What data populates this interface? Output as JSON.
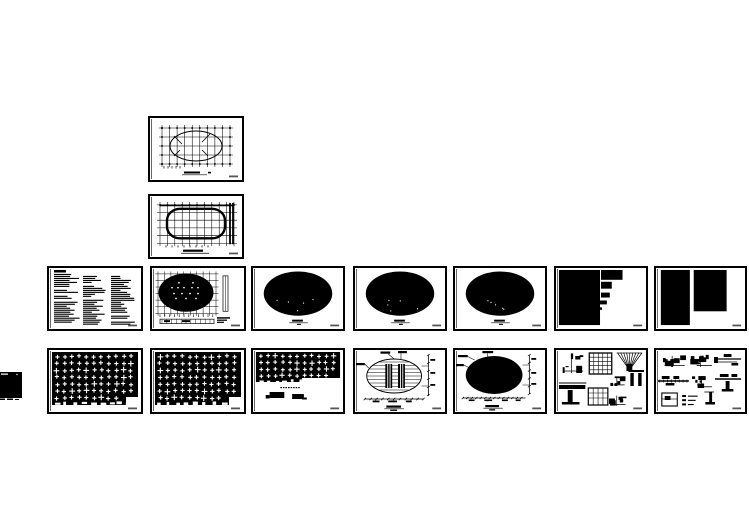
{
  "canvas": {
    "background": "#ffffff",
    "paper": "#ffffff",
    "ink": "#000000",
    "corner_mark": "#555555"
  },
  "sheets": [
    {
      "id": "S01",
      "name": "roof-framing-grid-plan",
      "type": "grid-ellipse",
      "row": 0,
      "col": 1,
      "seed": 11
    },
    {
      "id": "S02",
      "name": "foundation-grid-plan",
      "type": "grid-ring",
      "row": 1,
      "col": 1,
      "seed": 12
    },
    {
      "id": "S03",
      "name": "general-notes",
      "type": "notes",
      "row": 2,
      "col": 0,
      "seed": 21
    },
    {
      "id": "S04",
      "name": "pile-layout-plan",
      "type": "grid-filled-ellipse",
      "row": 2,
      "col": 1,
      "seed": 22
    },
    {
      "id": "S05",
      "name": "floor-plan-1",
      "type": "filled-ellipse",
      "row": 2,
      "col": 2,
      "seed": 23
    },
    {
      "id": "S06",
      "name": "floor-plan-2",
      "type": "filled-ellipse",
      "row": 2,
      "col": 3,
      "seed": 24
    },
    {
      "id": "S07",
      "name": "floor-plan-3",
      "type": "filled-ellipse",
      "row": 2,
      "col": 4,
      "seed": 25
    },
    {
      "id": "S08",
      "name": "schedule-table-1",
      "type": "blocks-a",
      "row": 2,
      "col": 5,
      "seed": 26
    },
    {
      "id": "S09",
      "name": "schedule-table-2",
      "type": "blocks-b",
      "row": 2,
      "col": 6,
      "seed": 27
    },
    {
      "id": "S10",
      "name": "framing-plan-dense-1",
      "type": "pile-grid",
      "row": 3,
      "col": 0,
      "seed": 31
    },
    {
      "id": "S11",
      "name": "framing-plan-dense-2",
      "type": "pile-grid",
      "row": 3,
      "col": 1,
      "seed": 32
    },
    {
      "id": "S12",
      "name": "framing-plan-partial",
      "type": "pile-partial",
      "row": 3,
      "col": 2,
      "seed": 33
    },
    {
      "id": "S13",
      "name": "roof-plan-with-cores",
      "type": "ellipse-hatch-cores",
      "row": 3,
      "col": 3,
      "seed": 34
    },
    {
      "id": "S14",
      "name": "roof-plan-filled",
      "type": "filled-ellipse-dims",
      "row": 3,
      "col": 4,
      "seed": 35
    },
    {
      "id": "S15",
      "name": "connection-details-1",
      "type": "details-a",
      "row": 3,
      "col": 5,
      "seed": 36
    },
    {
      "id": "S16",
      "name": "connection-details-2",
      "type": "details-b",
      "row": 3,
      "col": 6,
      "seed": 37
    },
    {
      "id": "S17",
      "name": "partial-sheet-left-edge",
      "type": "edge-partial",
      "seed": 41
    }
  ]
}
